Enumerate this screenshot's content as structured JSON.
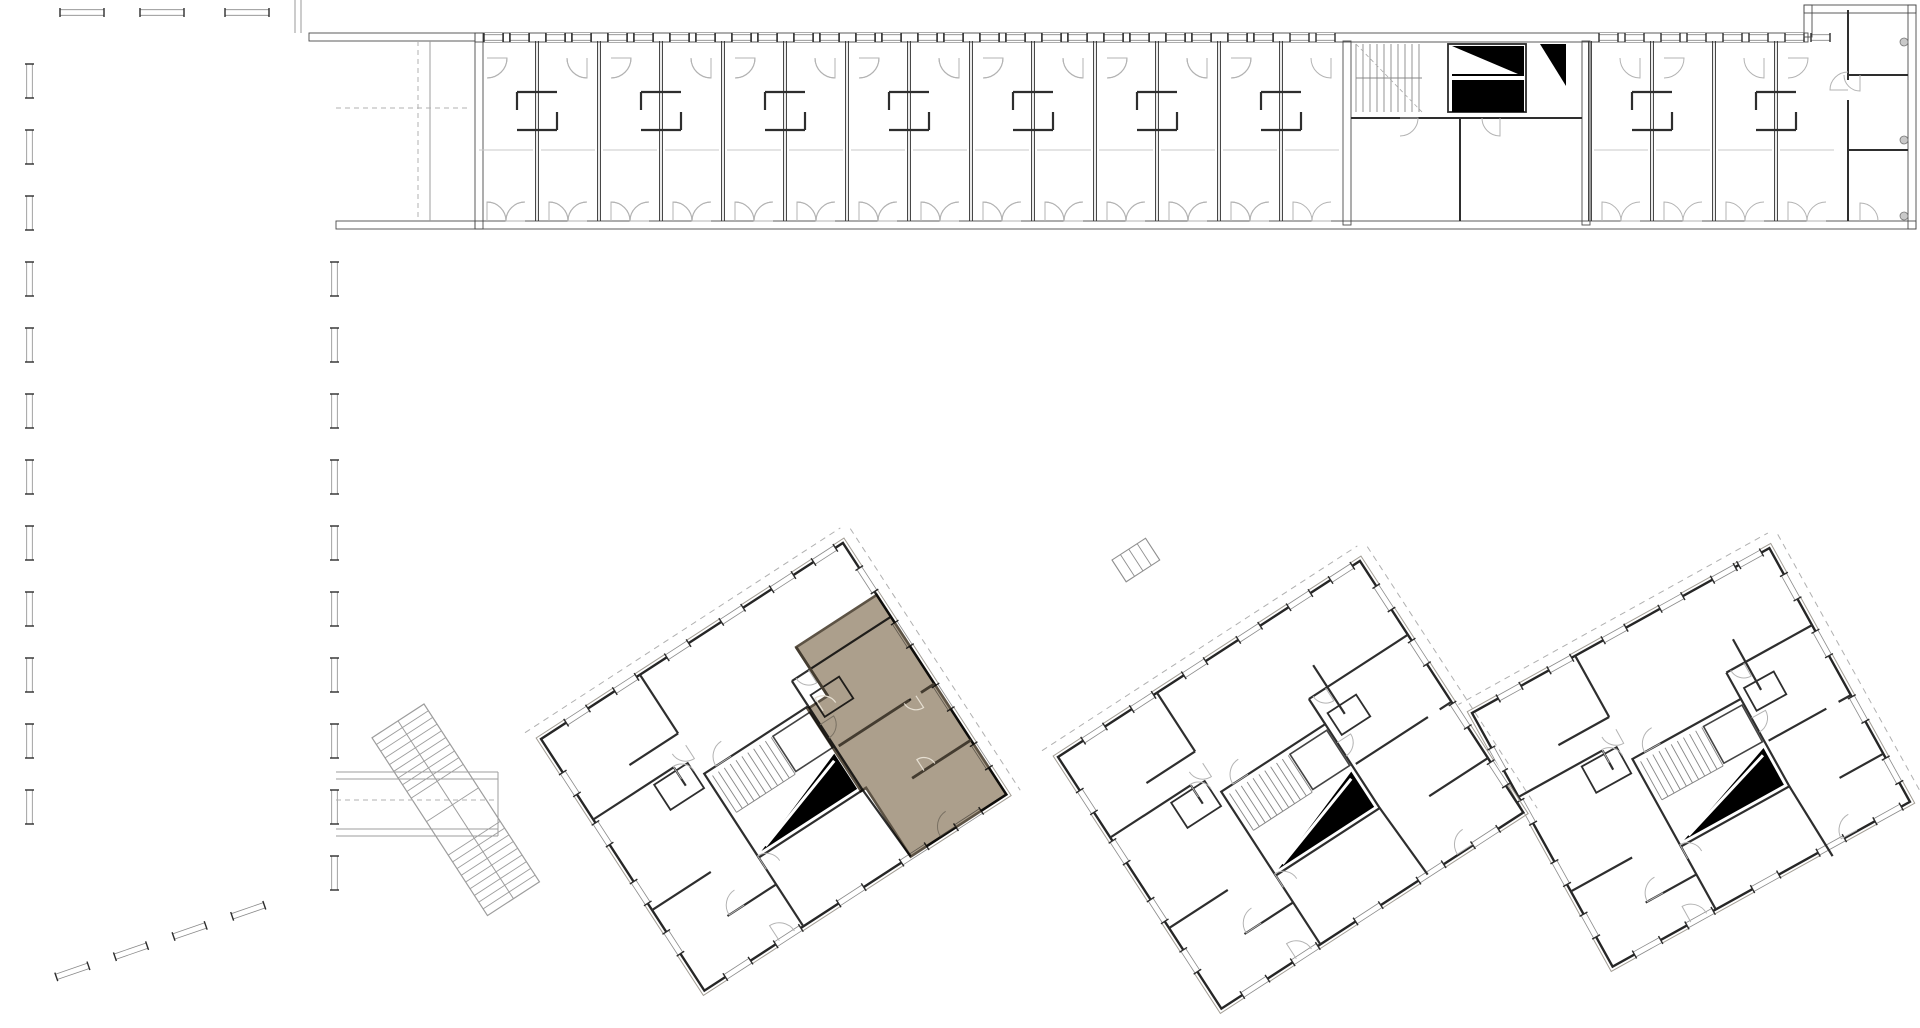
{
  "meta": {
    "type": "architectural-floor-plan",
    "view": "site-level-floor-plan"
  },
  "canvas": {
    "width": 1920,
    "height": 1028,
    "background": "#ffffff"
  },
  "palette": {
    "wall_dark": "#262626",
    "wall_medium": "#4c4c4c",
    "partition": "#2e2e2e",
    "line_light": "#9c9c9c",
    "line_faint": "#c8c8c8",
    "hatch_line": "#928e86",
    "hatch_bg": "#edebe7",
    "stair_fill": "#000000",
    "dash": "#b0b0b0",
    "door_arc": "#b3b3b3",
    "highlight_fill": "#a89a86",
    "highlight_edge": "#5d5345",
    "highlight_wall": "#443c30",
    "highlight_arc": "#e6dfd2"
  },
  "structures": {
    "west_slab": {
      "name": "west-slab-building",
      "room_rows": 7,
      "has_stair_core": true,
      "angled_south_facade": true
    },
    "north_wing": {
      "name": "north-wing-building",
      "bays_left": 13,
      "bays_right": 4,
      "has_stair_core": true,
      "has_end_block": true
    },
    "towers": [
      {
        "name": "tower-1",
        "rotation_deg": -33,
        "width": 360,
        "height": 300,
        "x": 541,
        "y": 739,
        "highlighted": true
      },
      {
        "name": "tower-2",
        "rotation_deg": -33,
        "width": 360,
        "height": 300,
        "x": 1058,
        "y": 757,
        "highlighted": false
      },
      {
        "name": "tower-3",
        "rotation_deg": -29,
        "width": 340,
        "height": 290,
        "x": 1472,
        "y": 713,
        "highlighted": false
      }
    ]
  },
  "highlight": {
    "tower": "tower-1",
    "fill": "#a89a86",
    "edge": "#5d5345",
    "blend": "multiply",
    "opacity": 0.95
  }
}
